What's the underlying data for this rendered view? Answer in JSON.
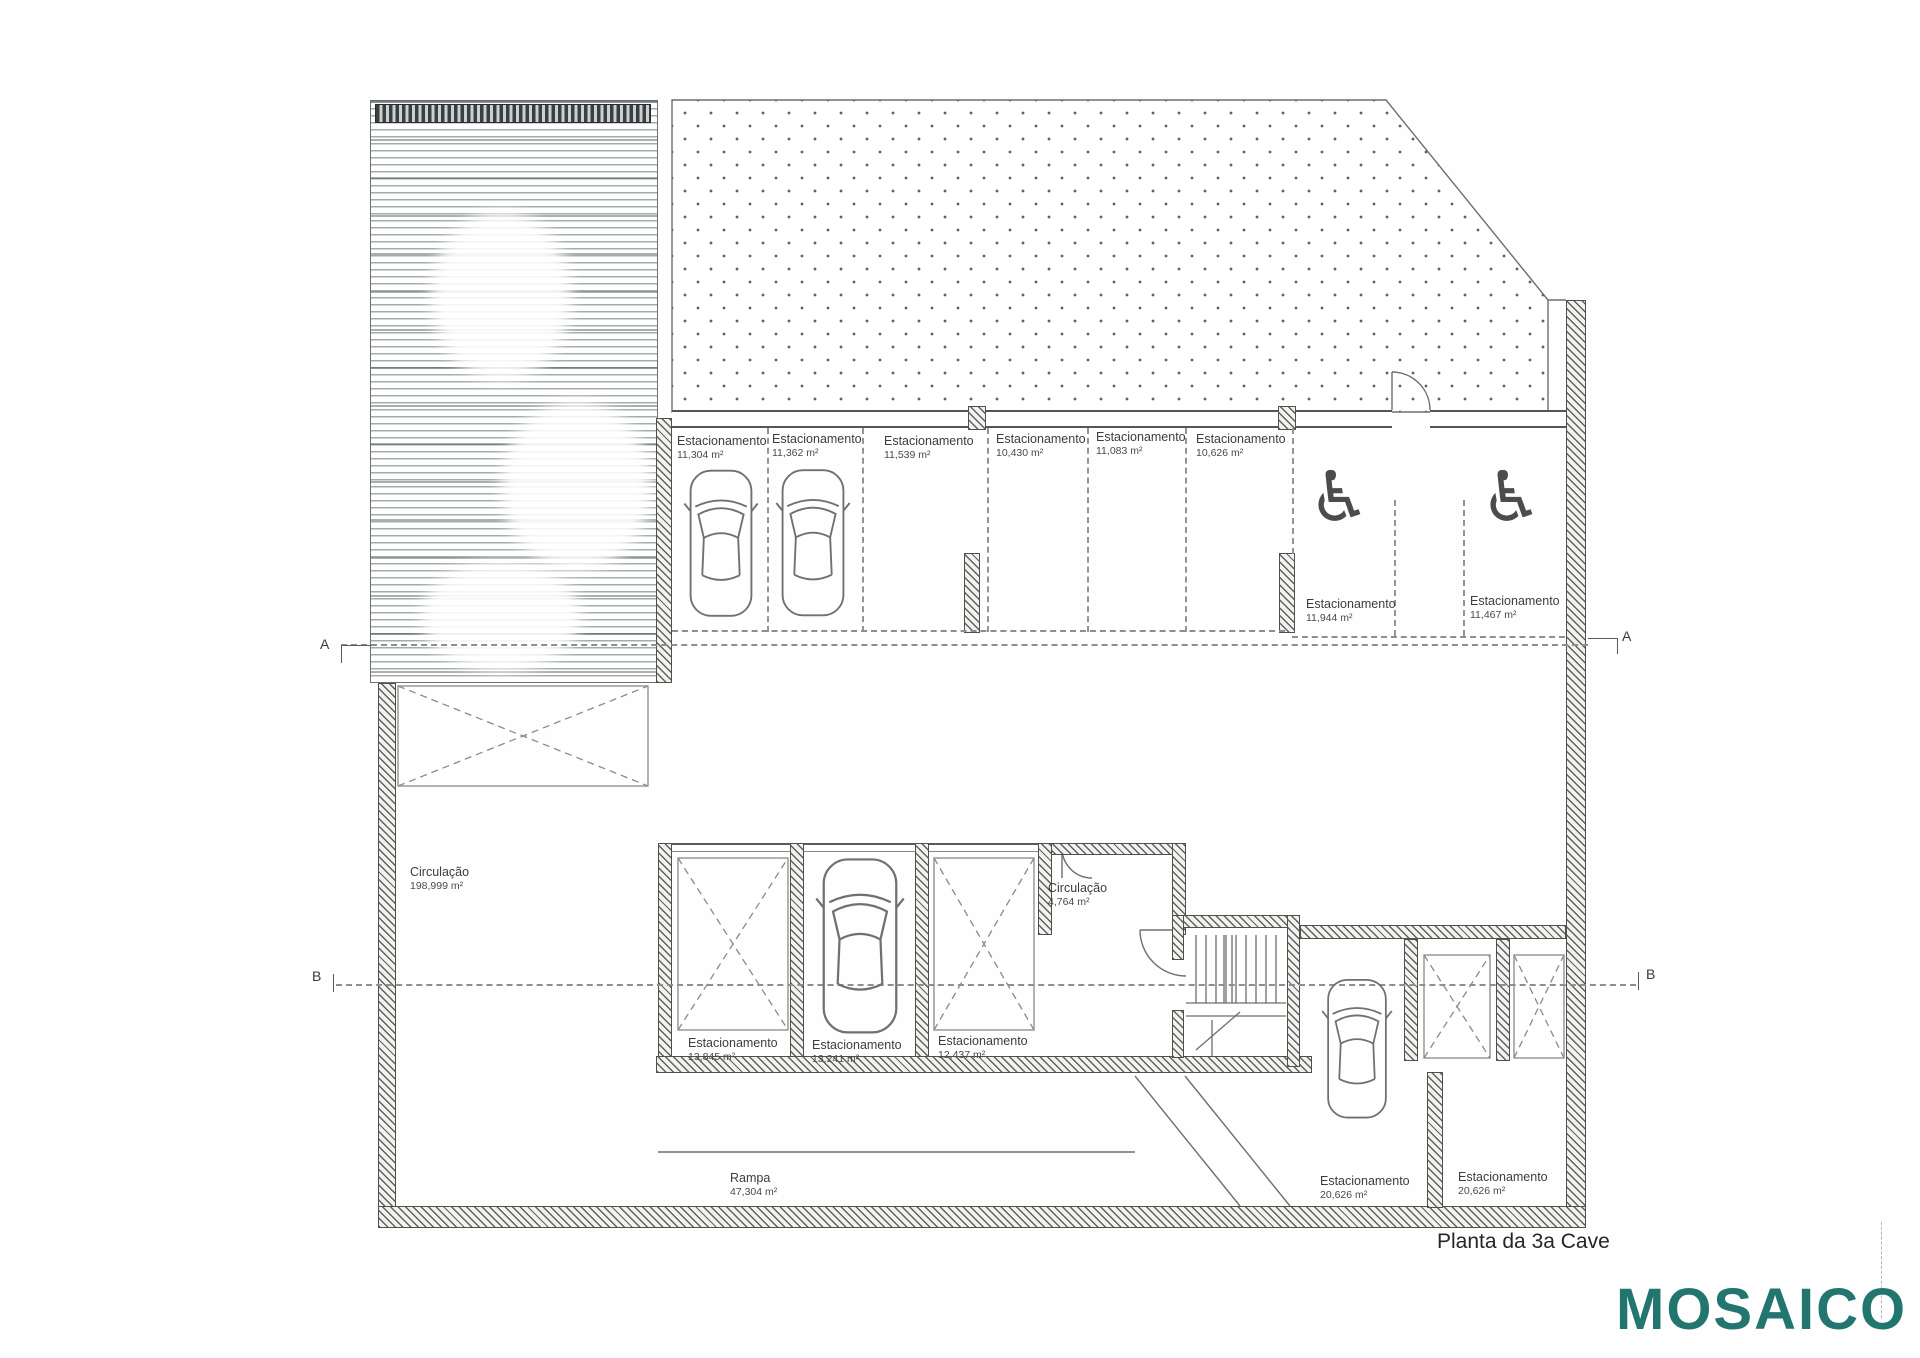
{
  "document": {
    "title": "Planta da 3a Cave",
    "logo": "MOSAICO",
    "logo_color": "#23756F"
  },
  "icons": {
    "wheelchair": "♿"
  },
  "section_markers": {
    "a": "A",
    "b": "B"
  },
  "rooms": {
    "circulacao_main": {
      "label": "Circulação",
      "area": "198,999 m²"
    },
    "circulacao_small": {
      "label": "Circulação",
      "area": "4,764 m²"
    },
    "rampa": {
      "label": "Rampa",
      "area": "47,304 m²"
    }
  },
  "parking_top": [
    {
      "label": "Estacionamento",
      "area": "11,304 m²"
    },
    {
      "label": "Estacionamento",
      "area": "11,362 m²"
    },
    {
      "label": "Estacionamento",
      "area": "11,539 m²"
    },
    {
      "label": "Estacionamento",
      "area": "10,430 m²"
    },
    {
      "label": "Estacionamento",
      "area": "11,083 m²"
    },
    {
      "label": "Estacionamento",
      "area": "10,626 m²"
    }
  ],
  "parking_accessible": [
    {
      "label": "Estacionamento",
      "area": "11,944 m²"
    },
    {
      "label": "Estacionamento",
      "area": "11,467 m²"
    }
  ],
  "parking_middle": [
    {
      "label": "Estacionamento",
      "area": "13,845 m²"
    },
    {
      "label": "Estacionamento",
      "area": "13,241 m²"
    },
    {
      "label": "Estacionamento",
      "area": "12,437 m²"
    }
  ],
  "parking_bottom": [
    {
      "label": "Estacionamento",
      "area": "20,626 m²"
    },
    {
      "label": "Estacionamento",
      "area": "20,626 m²"
    }
  ]
}
